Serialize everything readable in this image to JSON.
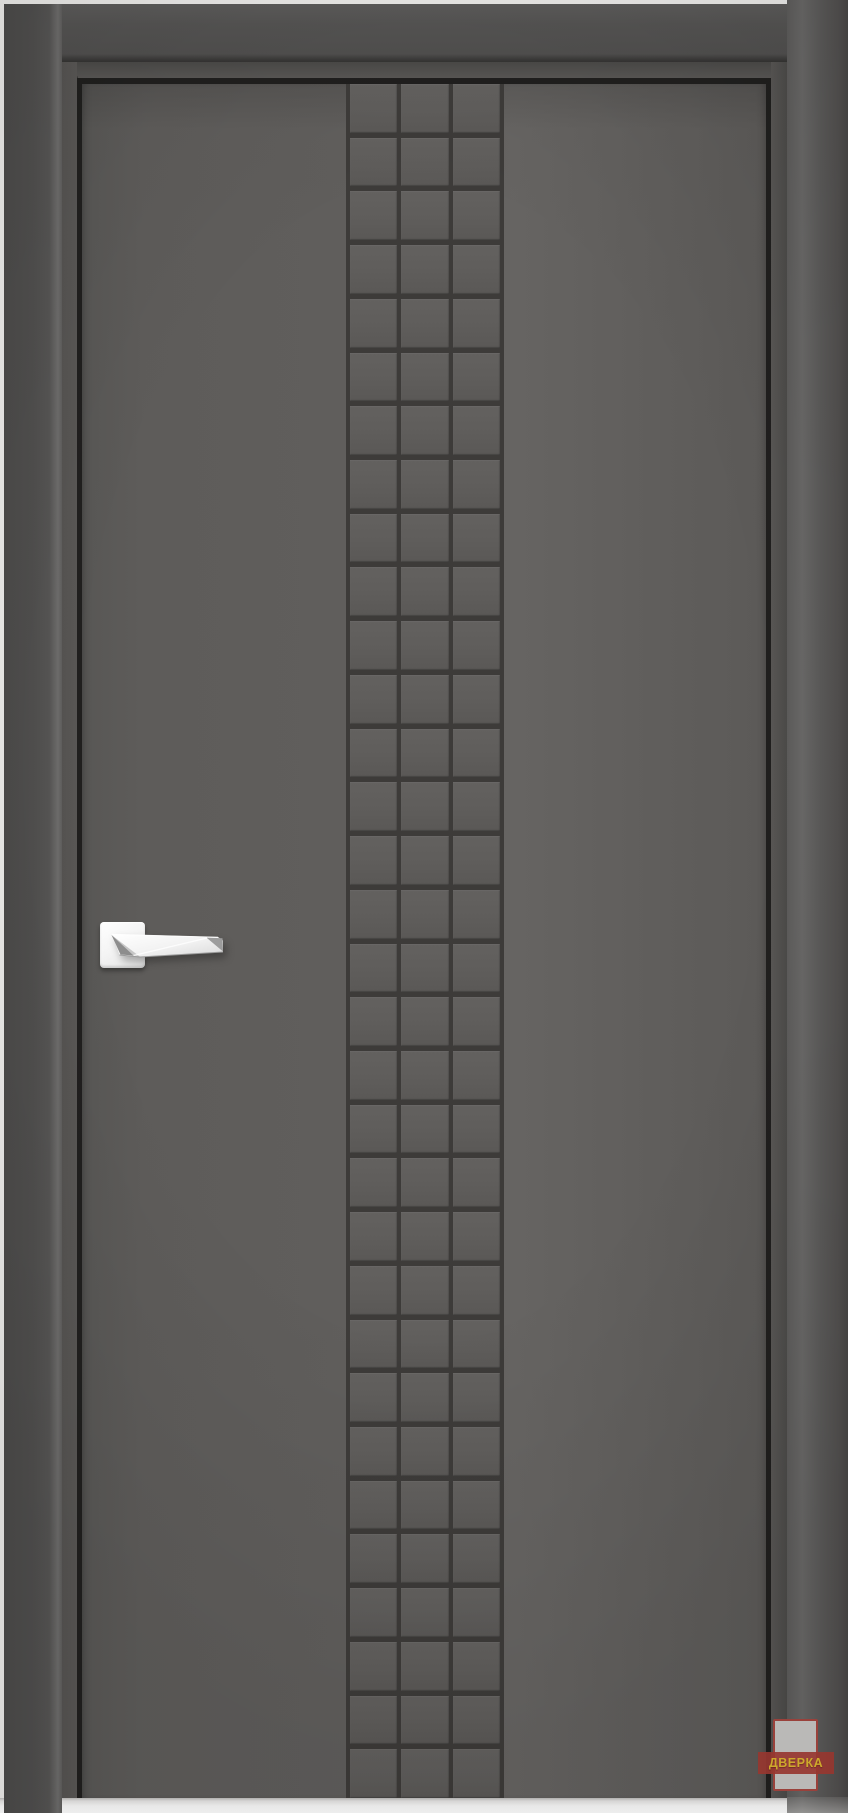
{
  "image": {
    "type": "interior-door-product-photo",
    "description": "Gray interior door with central checkered grid panel, chrome handle and watermark"
  },
  "watermark": {
    "text": "ДВЕРКА",
    "band_color": "#a23b33",
    "text_color": "#ddb52f",
    "panel_color": "#c8c7c5"
  },
  "door": {
    "grid": {
      "rows": 32,
      "columns": 3
    },
    "handle_side": "left",
    "handle_finish": "polished-chrome"
  },
  "colors": {
    "background": "#eae9e7",
    "floor": "#ffffff",
    "leaf": "#605e5c",
    "groove": "#3d3b39",
    "casing": "#504f4e",
    "reveal": "#555351",
    "gap": "#201f1e",
    "chrome": "#f5f5f5",
    "watermark_band": "#a23b33",
    "watermark_text": "#ddb52f",
    "watermark_panel": "#c8c7c5"
  }
}
